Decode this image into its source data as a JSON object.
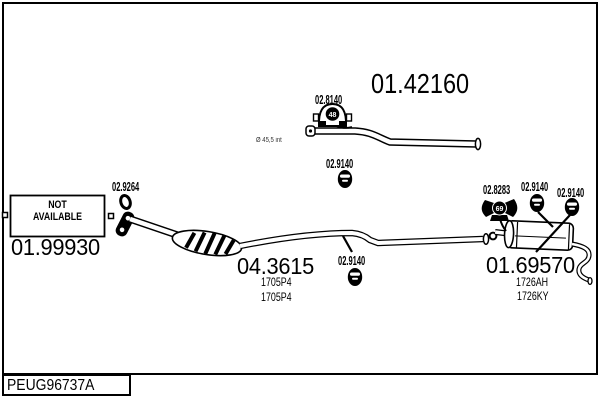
{
  "colors": {
    "ink": "#000000",
    "paper": "#ffffff"
  },
  "title_block": {
    "code": "PEUG96737A"
  },
  "annotations": {
    "pipe_note": "Ø 45,5 int"
  },
  "sections": {
    "front_pipe": {
      "part_number": "01.42160"
    },
    "front_section": {
      "part_number": "01.99930",
      "availability": [
        "NOT",
        "AVAILABLE"
      ]
    },
    "center_section": {
      "part_number": "04.3615",
      "oe_codes": [
        "1705P4",
        "1705P4"
      ]
    },
    "rear_silencer": {
      "part_number": "01.69570",
      "oe_codes": [
        "1726AH",
        "1726KY"
      ]
    }
  },
  "mountings": {
    "clamp_front": {
      "part_number": "02.8140",
      "badge": "48"
    },
    "ring_gasket": {
      "part_number": "02.9264"
    },
    "hanger_front": {
      "part_number": "02.9140"
    },
    "hanger_center": {
      "part_number": "02.9140"
    },
    "clamp_rear": {
      "part_number": "02.8283",
      "badge": "69"
    },
    "hanger_rear_left": {
      "part_number": "02.9140"
    },
    "hanger_rear_right": {
      "part_number": "02.9140"
    }
  }
}
